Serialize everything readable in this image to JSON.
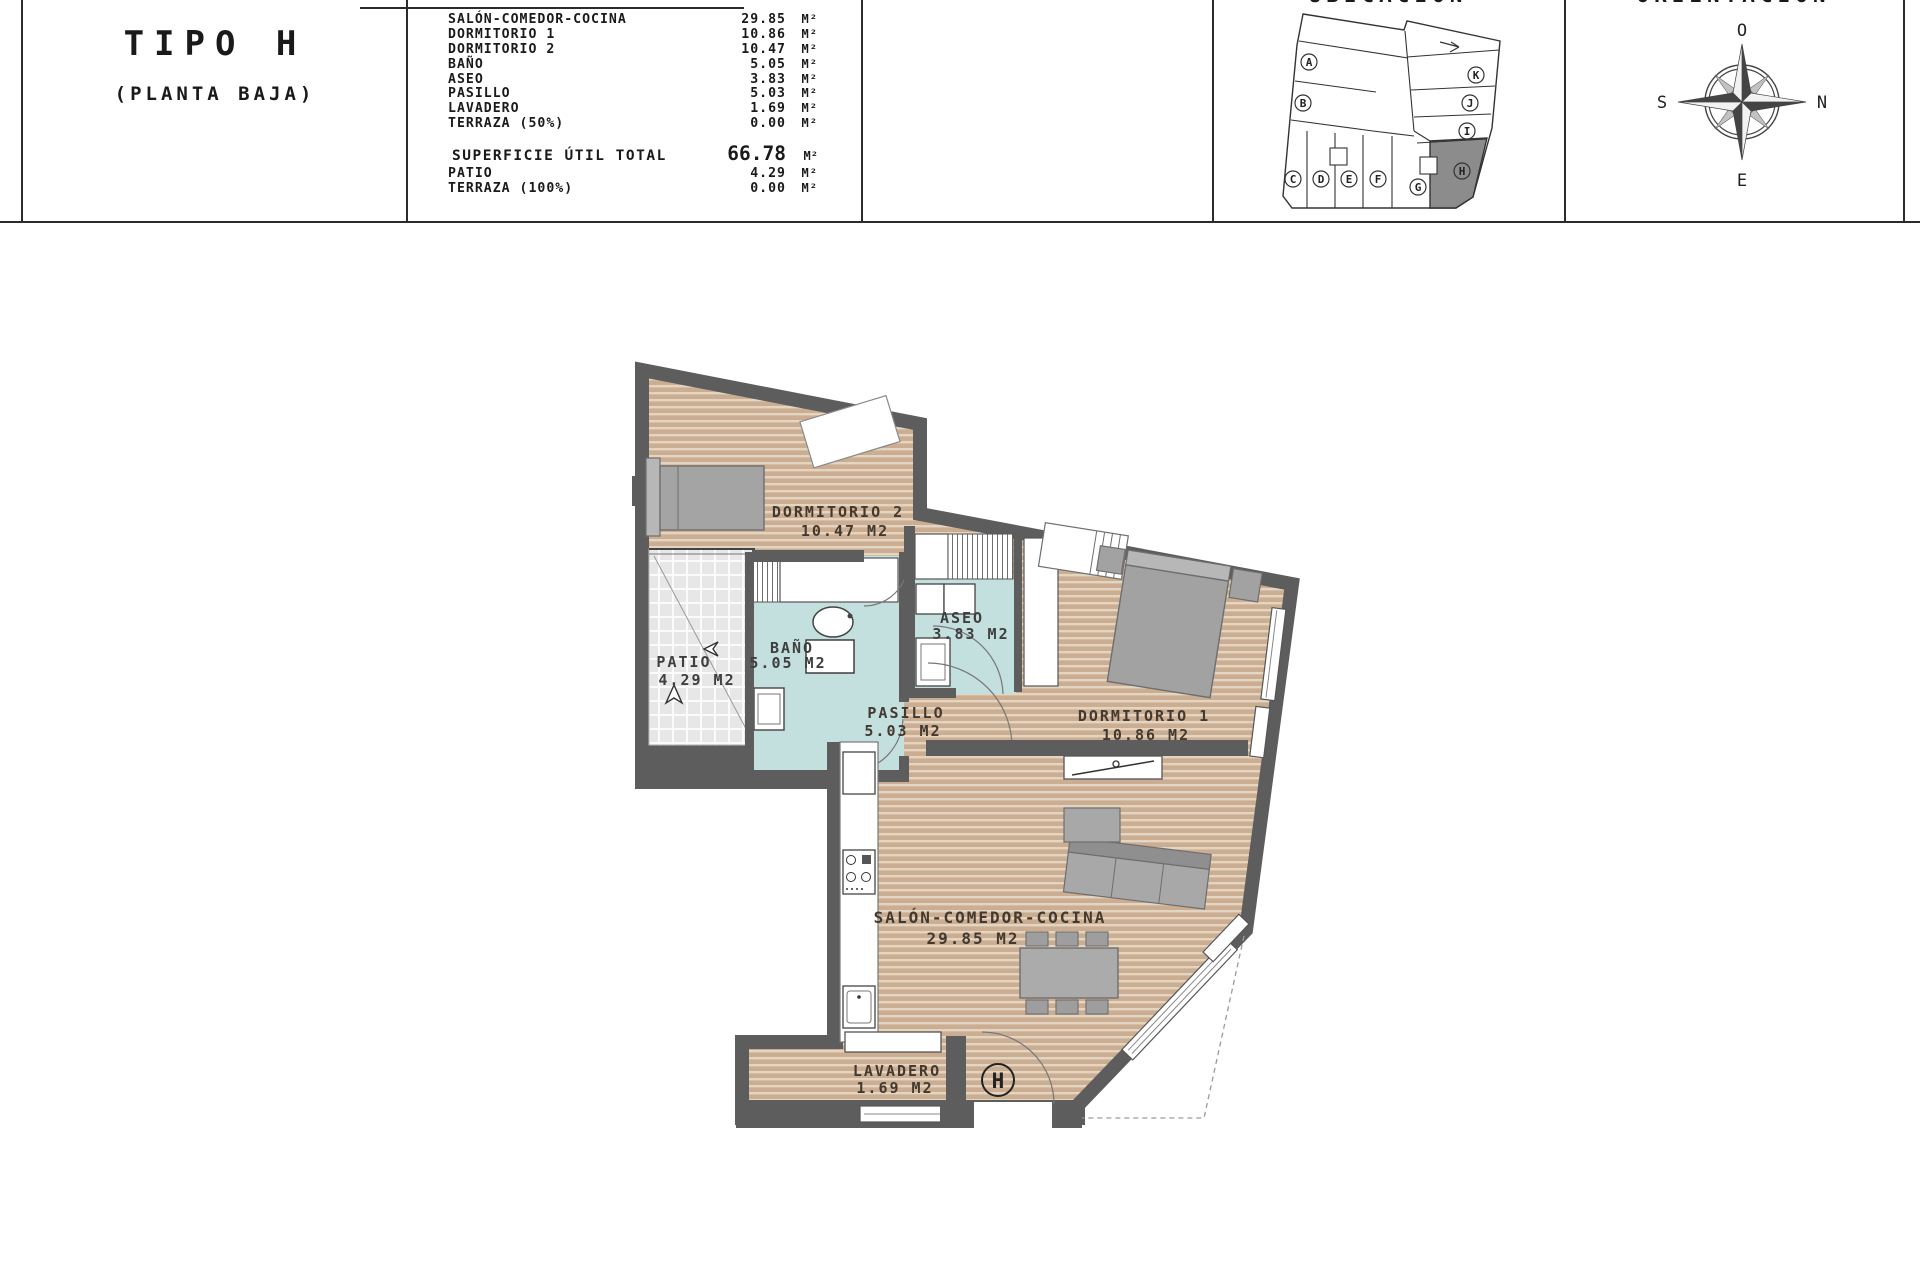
{
  "title_panel": {
    "line1": "TIPO H",
    "line2": "(PLANTA BAJA)"
  },
  "area_table": {
    "rows": [
      {
        "label": "SALÓN-COMEDOR-COCINA",
        "value": "29.85",
        "unit": "M²"
      },
      {
        "label": "DORMITORIO 1",
        "value": "10.86",
        "unit": "M²"
      },
      {
        "label": "DORMITORIO 2",
        "value": "10.47",
        "unit": "M²"
      },
      {
        "label": "BAÑO",
        "value": "5.05",
        "unit": "M²"
      },
      {
        "label": "ASEO",
        "value": "3.83",
        "unit": "M²"
      },
      {
        "label": "PASILLO",
        "value": "5.03",
        "unit": "M²"
      },
      {
        "label": "LAVADERO",
        "value": "1.69",
        "unit": "M²"
      },
      {
        "label": "TERRAZA (50%)",
        "value": "0.00",
        "unit": "M²"
      }
    ],
    "total": {
      "label": "SUPERFICIE ÚTIL TOTAL",
      "value": "66.78",
      "unit": "M²"
    },
    "extra_rows": [
      {
        "label": "PATIO",
        "value": "4.29",
        "unit": "M²"
      },
      {
        "label": "TERRAZA (100%)",
        "value": "0.00",
        "unit": "M²"
      }
    ]
  },
  "ubicacion": {
    "title": "UBICACIÓN",
    "units": [
      {
        "letter": "A"
      },
      {
        "letter": "B"
      },
      {
        "letter": "C"
      },
      {
        "letter": "D"
      },
      {
        "letter": "E"
      },
      {
        "letter": "F"
      },
      {
        "letter": "G"
      },
      {
        "letter": "H",
        "highlighted": true
      },
      {
        "letter": "I"
      },
      {
        "letter": "J"
      },
      {
        "letter": "K"
      }
    ],
    "highlight_color": "#8c8c8c"
  },
  "orientacion": {
    "title": "ORIENTACIÓN",
    "labels": {
      "top": "O",
      "right": "N",
      "left": "S",
      "bottom": "E"
    }
  },
  "plan": {
    "rooms": {
      "dorm2": {
        "name": "DORMITORIO 2",
        "area": "10.47 M2"
      },
      "patio": {
        "name": "PATIO",
        "area": "4.29 M2"
      },
      "bano": {
        "name": "BAÑO",
        "area": "5.05 M2"
      },
      "aseo": {
        "name": "ASEO",
        "area": "3.83 M2"
      },
      "pasillo": {
        "name": "PASILLO",
        "area": "5.03 M2"
      },
      "dorm1": {
        "name": "DORMITORIO 1",
        "area": "10.86 M2"
      },
      "salon": {
        "name": "SALÓN-COMEDOR-COCINA",
        "area": "29.85 M2"
      },
      "lavadero": {
        "name": "LAVADERO",
        "area": "1.69 M2"
      }
    },
    "entry_label": "H",
    "colors": {
      "wall": "#5d5d5d",
      "wood": "#cbae92",
      "wet_room": "#c3dfde",
      "patio_tile": "#e7e7e7"
    }
  }
}
